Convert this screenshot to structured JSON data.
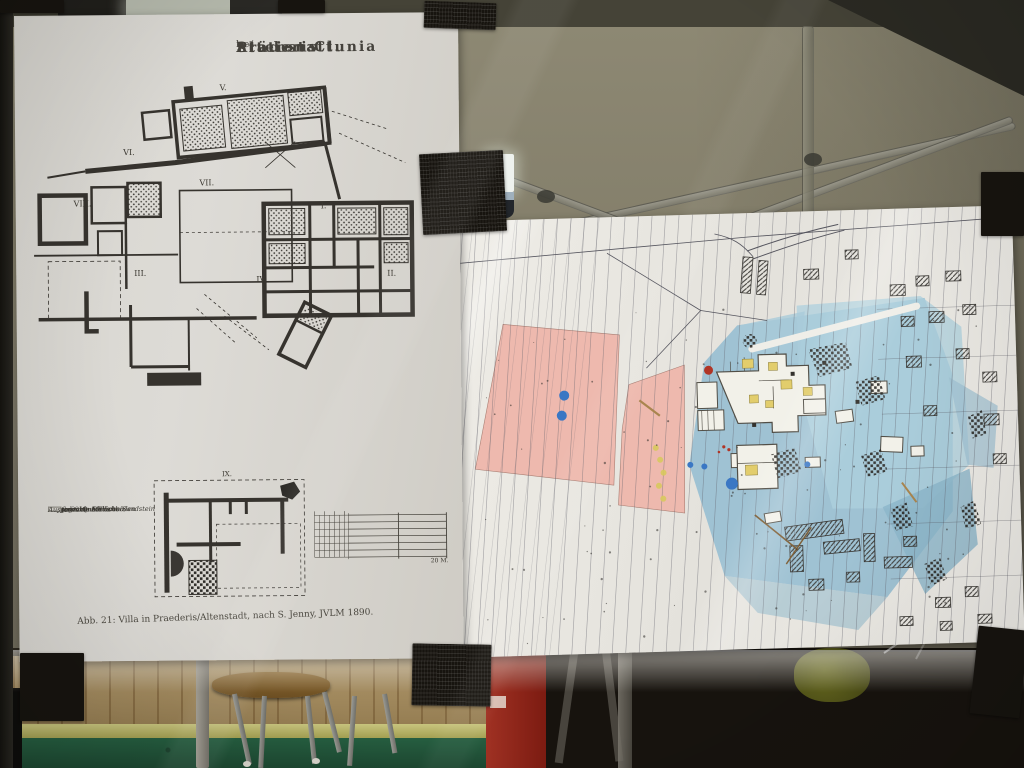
{
  "photo": {
    "left_poster": {
      "title_parts": [
        "Station Clunia",
        "in",
        "Präderis",
        "bei",
        "Altenstatt."
      ],
      "plan_labels": {
        "v": "V.",
        "vi": "VI.",
        "vii": "VII.",
        "viii": "VIII.",
        "i": "I.",
        "ii": "II.",
        "iii": "III.",
        "iv": "IV.",
        "ix": "IX."
      },
      "legend_items": [
        {
          "label": "Aufgedeckte Mauern",
          "swatch": "solid"
        },
        {
          "label": "Gussmörtel",
          "swatch": "hatch"
        },
        {
          "label": "Platten & Quader von Sandstein",
          "swatch": "slab"
        },
        {
          "label": "Gepflasterte Stellen",
          "swatch": "grid"
        },
        {
          "label": "Aufgedeckte Estrichböden",
          "swatch": "estrich"
        },
        {
          "label": "Ausgegrabene Flächen",
          "swatch": "plain"
        }
      ],
      "scale_label": "20 M.",
      "caption": "Abb. 21: Villa in Praederis/Altenstadt, nach S. Jenny, JVLM 1890."
    },
    "right_poster": {
      "markers": {
        "blue_dots": [
          [
            113,
            177,
            5
          ],
          [
            110,
            197,
            5
          ],
          [
            237,
            250,
            3
          ],
          [
            251,
            252,
            3
          ],
          [
            278,
            270,
            6
          ],
          [
            354,
            253,
            3
          ]
        ],
        "red_dots": [
          [
            258,
            156,
            4.5
          ],
          [
            271,
            233,
            1.6
          ],
          [
            276,
            236,
            1.6
          ],
          [
            266,
            238,
            1.3
          ]
        ],
        "yellow_dots": [
          [
            203,
            232,
            3
          ],
          [
            207,
            244,
            3
          ],
          [
            210,
            257,
            3
          ],
          [
            205,
            270,
            3
          ],
          [
            209,
            283,
            3
          ]
        ]
      },
      "colors": {
        "field_pink": "#eeb9ae",
        "site_blue": "#a3c6d6",
        "marker_blue": "#3a77c4",
        "marker_red": "#b03526",
        "marker_yellow": "#d8c95f"
      }
    },
    "scene_colors": {
      "tape": "#17140f",
      "left_paper": "#d8d6d0",
      "right_paper": "#eae8e2",
      "wall": "#837f6d",
      "floor_green": "#2c6e4b",
      "wood": "#a78c5b"
    }
  }
}
